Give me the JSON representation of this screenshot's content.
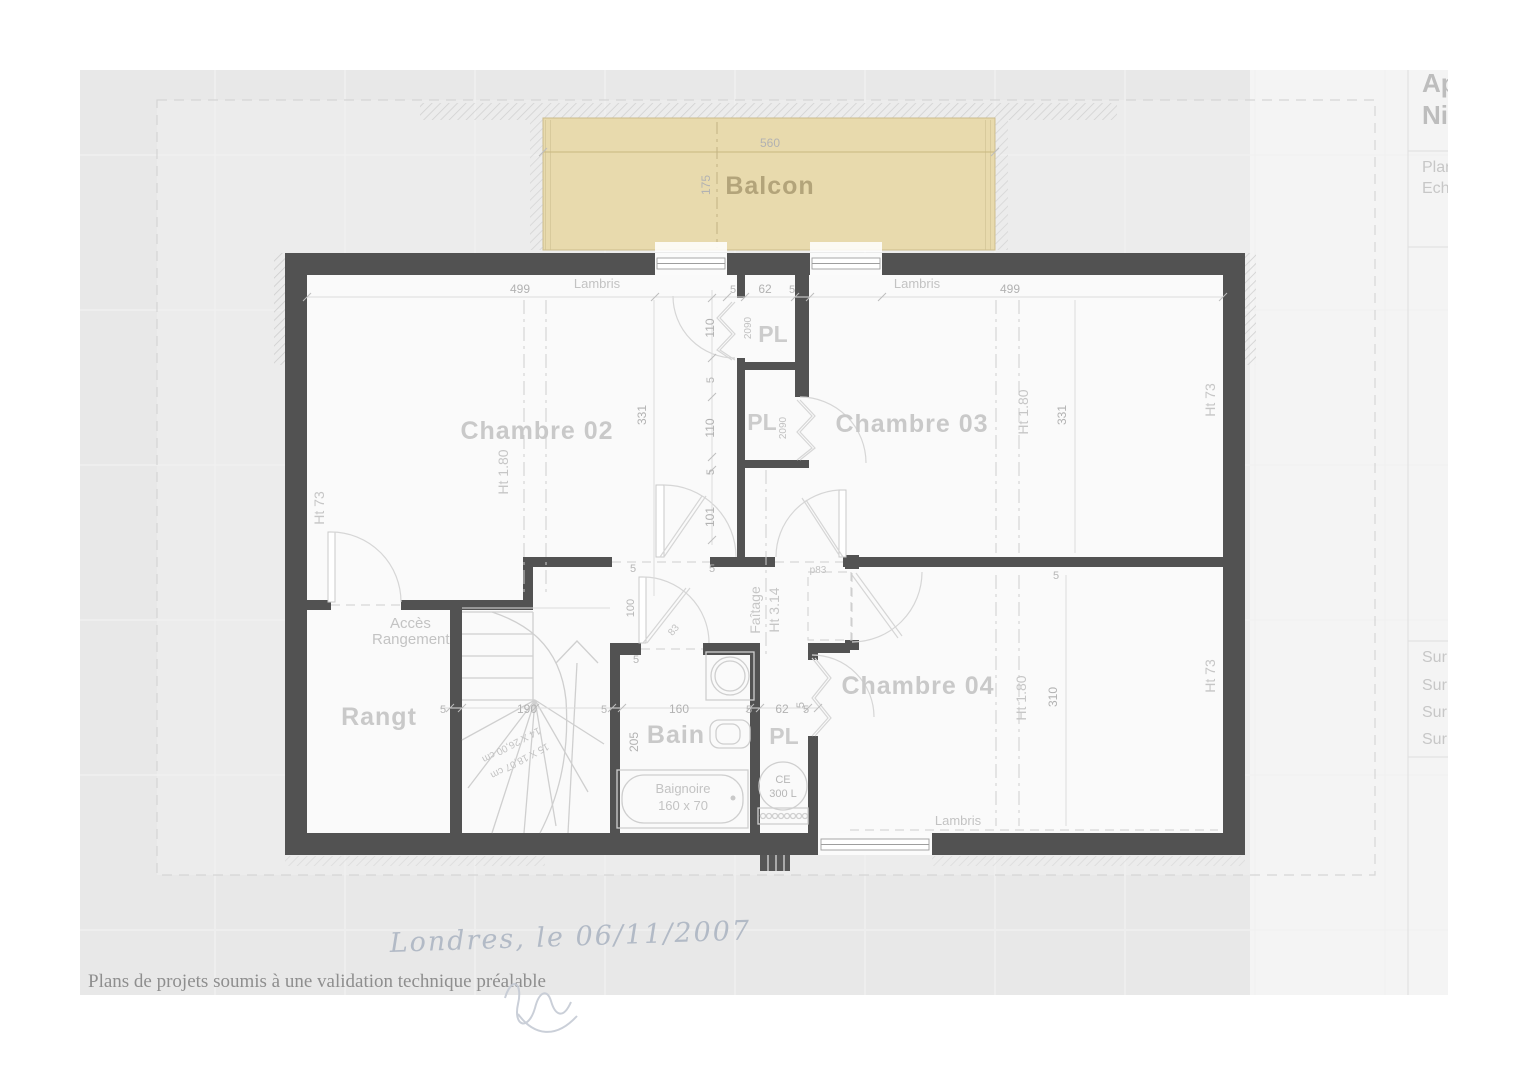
{
  "page": {
    "caption": "Plans de projets soumis à une validation technique préalable",
    "handwriting": "Londres, le 06/11/2007"
  },
  "title_block": {
    "project_line1": "Ap",
    "project_line2": "Ni",
    "plan_label": "Plan",
    "echelle_label": "Ech",
    "surface_lines": [
      "Sur",
      "Sur",
      "Sur",
      "Sur"
    ]
  },
  "rooms": {
    "balcon": "Balcon",
    "chambre02": "Chambre 02",
    "chambre03": "Chambre 03",
    "chambre04": "Chambre 04",
    "rangt": "Rangt",
    "bain": "Bain",
    "pl_top": "PL",
    "pl_mid": "PL",
    "pl_ce": "PL",
    "acces_line1": "Accès",
    "acces_line2": "Rangement"
  },
  "annotations": {
    "lambris_top_left": "Lambris",
    "lambris_top_right": "Lambris",
    "lambris_bottom": "Lambris",
    "faitage_line1": "Faîtage",
    "faitage_line2": "Ht 3.14",
    "baignoire_line1": "Baignoire",
    "baignoire_line2": "160 x 70",
    "ce_line1": "CE",
    "ce_line2": "300 L",
    "stairs_line1": "15 X 18,07 cm",
    "stairs_line2": "14 X 26,00 cm",
    "door_hall": "p83",
    "door_bain": "83",
    "door_pl_top": "2090",
    "door_pl_mid": "2090",
    "ht180_c02": "Ht 1.80",
    "ht180_c03": "Ht 1.80",
    "ht180_c04": "Ht 1.80",
    "ht73_left": "Ht 73",
    "ht73_right_top": "Ht 73",
    "ht73_right_bottom": "Ht 73"
  },
  "dimensions": {
    "balcon_width": "560",
    "balcon_depth": "175",
    "top_left": "499",
    "top_pl_5a": "5",
    "top_pl_62": "62",
    "top_pl_5b": "5",
    "top_right": "499",
    "pl_door_110a": "110",
    "pl_5a": "5",
    "pl_door_110b": "110",
    "pl_5b": "5",
    "hall_101": "101",
    "c02_331": "331",
    "c03_331": "331",
    "c04_310": "310",
    "c04_5": "5",
    "hall_5a": "5",
    "hall_5b": "5",
    "bain_100": "100",
    "bain_5": "5",
    "chain_5a": "5",
    "chain_190": "190",
    "chain_5b": "5",
    "chain_160": "160",
    "chain_5c": "5",
    "chain_62": "62",
    "chain_5d": "5",
    "bain_205": "205",
    "pl4_5": "5"
  }
}
